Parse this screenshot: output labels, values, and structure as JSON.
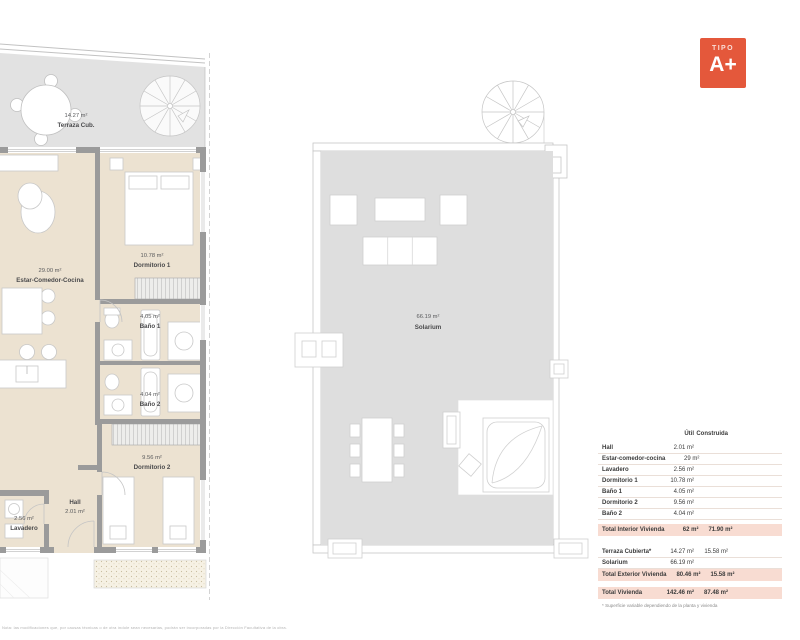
{
  "badge": {
    "kicker": "TIPO",
    "title": "A+",
    "color": "#e4583b"
  },
  "plans": {
    "apartment": {
      "terraza": {
        "area": "14.27 m²",
        "name": "Terraza Cub."
      },
      "estar": {
        "area": "29.00 m²",
        "name": "Estar-Comedor-Cocina"
      },
      "dormitorio1": {
        "area": "10.78 m²",
        "name": "Dormitorio 1"
      },
      "bano1": {
        "area": "4.05 m²",
        "name": "Baño 1"
      },
      "bano2": {
        "area": "4.04 m²",
        "name": "Baño 2"
      },
      "dormitorio2": {
        "area": "9.56 m²",
        "name": "Dormitorio 2"
      },
      "hall": {
        "name": "Hall",
        "area": "2.01 m²"
      },
      "lavadero": {
        "area": "2.56 m²",
        "name": "Lavadero"
      }
    },
    "roof": {
      "solarium": {
        "area": "66.19 m²",
        "name": "Solarium"
      }
    }
  },
  "surface_table": {
    "col_util": "Útil",
    "col_construida": "Construida",
    "rows": [
      {
        "label": "Hall",
        "util": "2.01 m²",
        "construida": ""
      },
      {
        "label": "Estar-comedor-cocina",
        "util": "29 m²",
        "construida": ""
      },
      {
        "label": "Lavadero",
        "util": "2.56 m²",
        "construida": ""
      },
      {
        "label": "Dormitorio 1",
        "util": "10.78 m²",
        "construida": ""
      },
      {
        "label": "Baño 1",
        "util": "4.05 m²",
        "construida": ""
      },
      {
        "label": "Dormitorio 2",
        "util": "9.56 m²",
        "construida": ""
      },
      {
        "label": "Baño 2",
        "util": "4.04 m²",
        "construida": ""
      }
    ],
    "total_interior": {
      "label": "Total Interior Vivienda",
      "util": "62 m²",
      "construida": "71.90 m²"
    },
    "exterior_rows": [
      {
        "label": "Terraza Cubierta*",
        "util": "14.27 m²",
        "construida": "15.58 m²"
      },
      {
        "label": "Solarium",
        "util": "66.19 m²",
        "construida": ""
      }
    ],
    "total_exterior": {
      "label": "Total Exterior Vivienda",
      "util": "80.46 m²",
      "construida": "15.58 m²"
    },
    "total": {
      "label": "Total Vivienda",
      "util": "142.46 m²",
      "construida": "87.48 m²"
    },
    "footnote": "* Superficie variable dependiendo de la planta y vivienda"
  },
  "disclaimer": "Nota: las modificaciones que, por causas técnicas o de otra índole sean necesarias, podrán ser incorporadas por la Dirección Facultativa de la obra.",
  "colors": {
    "accent_orange": "#e4583b",
    "floor_beige": "#ece2d1",
    "terrace_gray": "#e2e2e2",
    "solarium_gray": "#dedede",
    "wall_gray": "#9b9b9b",
    "table_highlight_pink": "#f8dcd2"
  }
}
